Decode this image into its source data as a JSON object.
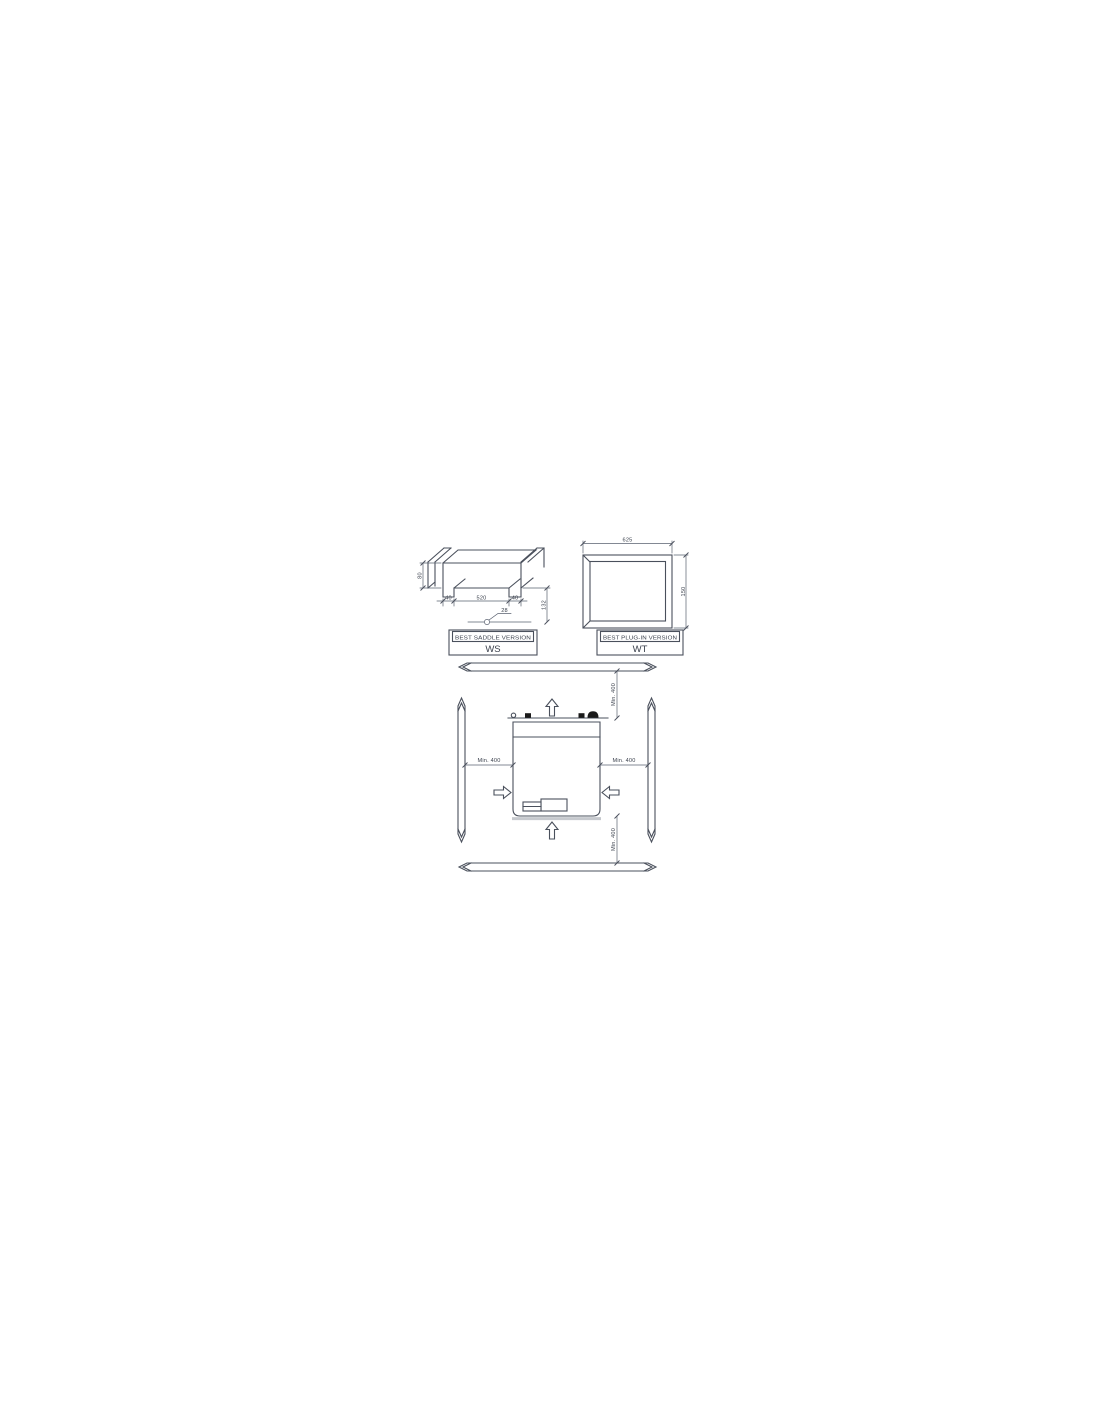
{
  "colors": {
    "background": "#ffffff",
    "line": "#4a505c",
    "dimension_line": "#5a6170",
    "text": "#3c424e",
    "bracket_fill": "#1a1a1a",
    "shadow": "#c6c9ce"
  },
  "ws_view": {
    "title": "BEST SADDLE VERSION",
    "code": "WS",
    "dims": {
      "height": "80",
      "left_foot": "40",
      "span": "520",
      "right_foot": "40",
      "drop": "132",
      "hole": "28"
    }
  },
  "wt_view": {
    "title": "BEST PLUG-IN VERSION",
    "code": "WT",
    "dims": {
      "width": "625",
      "height": "150"
    }
  },
  "clearance": {
    "top": "Min. 400",
    "bottom": "Min. 400",
    "left": "Min. 400",
    "right": "Min. 400"
  }
}
